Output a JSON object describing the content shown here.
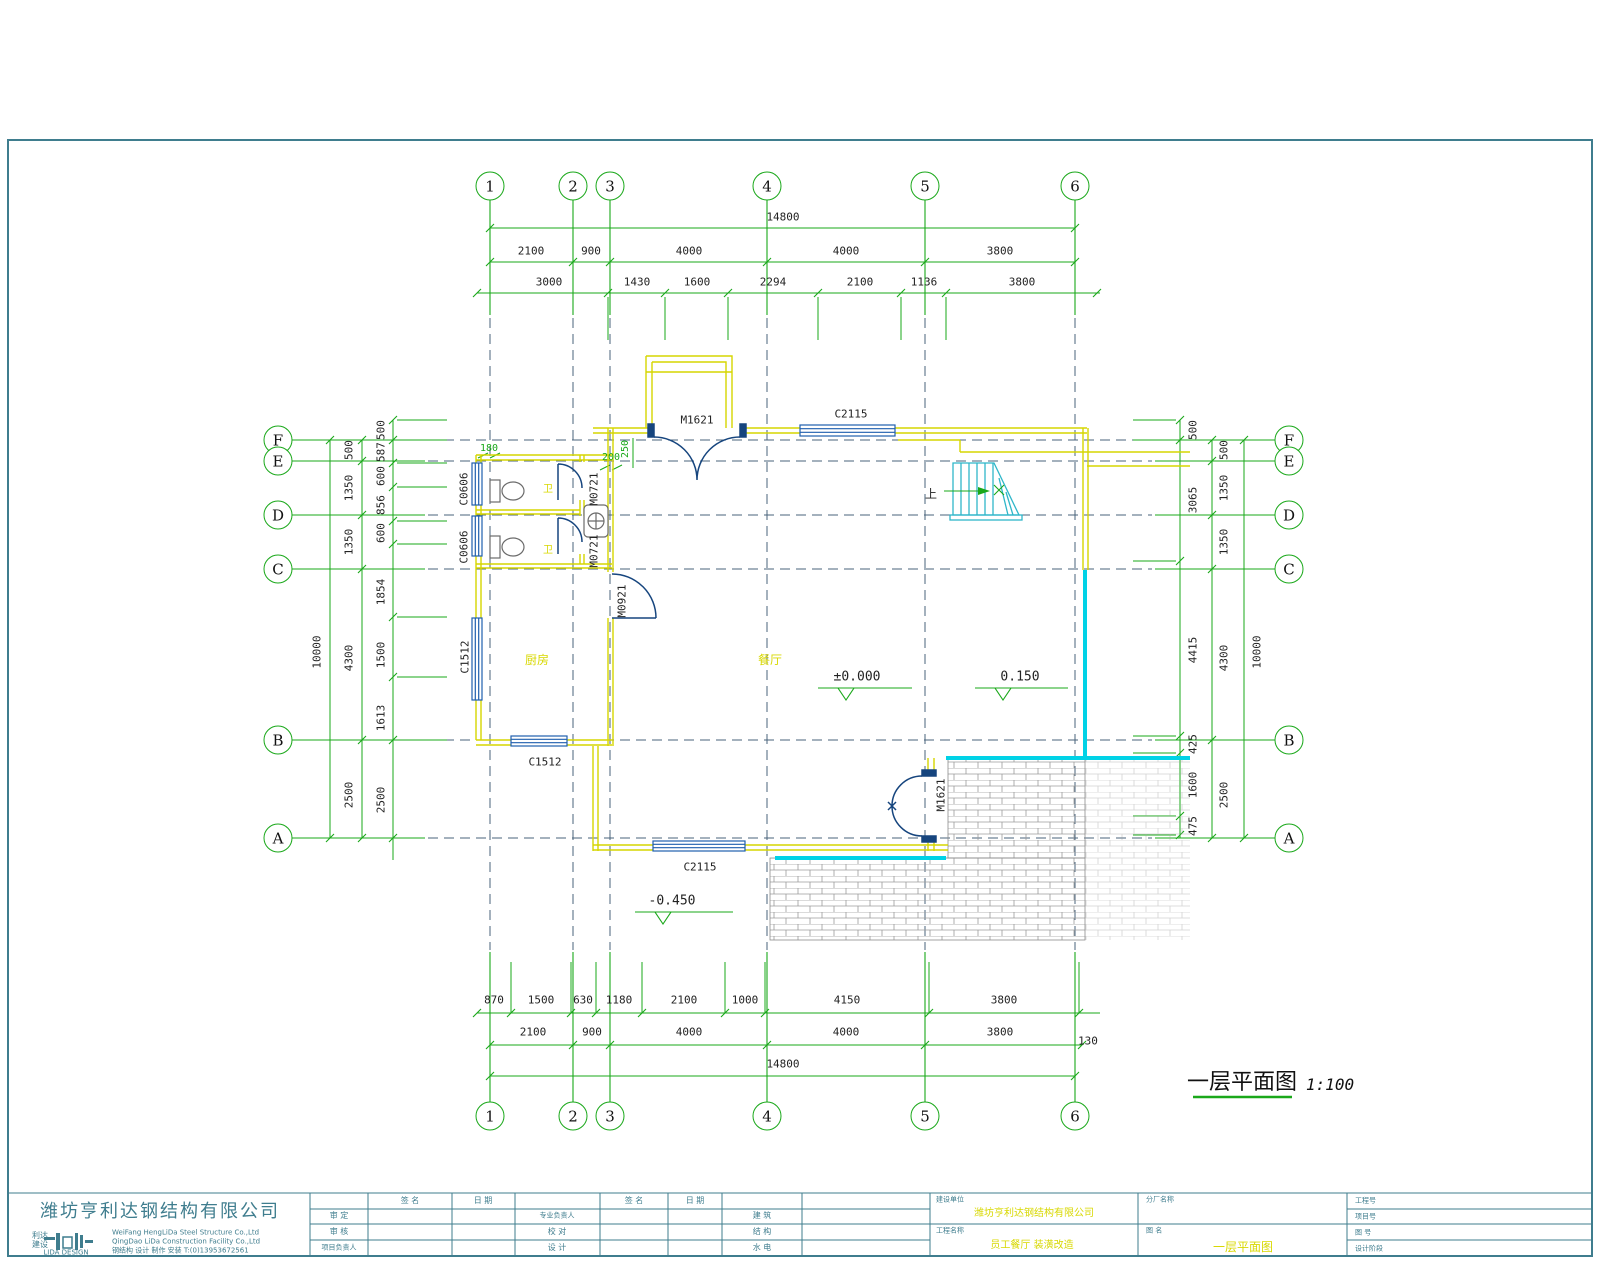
{
  "sheet": {
    "plan_title": "一层平面图",
    "plan_scale": "1:100"
  },
  "grid": {
    "cols": [
      "1",
      "2",
      "3",
      "4",
      "5",
      "6"
    ],
    "rows": [
      "F",
      "E",
      "D",
      "C",
      "B",
      "A"
    ]
  },
  "dims": {
    "top_total": "14800",
    "top_row1": [
      "2100",
      "900",
      "4000",
      "4000",
      "3800"
    ],
    "top_row2": [
      "3000",
      "1430",
      "1600",
      "2294",
      "2100",
      "1136",
      "3800"
    ],
    "bottom_row1": [
      "870",
      "1500",
      "630",
      "1180",
      "2100",
      "1000",
      "4150",
      "3800"
    ],
    "bottom_row2": [
      "2100",
      "900",
      "4000",
      "4000",
      "3800"
    ],
    "bottom_offset": "130",
    "bottom_total": "14800",
    "left_outer": "10000",
    "left_mid": [
      "500",
      "1350",
      "1350",
      "4300",
      "2500"
    ],
    "left_inner": [
      "500",
      "587",
      "600",
      "856",
      "600",
      "1854",
      "1500",
      "1613",
      "2500"
    ],
    "right_outer": "10000",
    "right_mid": [
      "500",
      "1350",
      "1350",
      "4300",
      "2500"
    ],
    "right_inner": [
      "500",
      "3065",
      "4415",
      "425",
      "1600",
      "475"
    ],
    "inline": [
      "180",
      "200",
      "250"
    ]
  },
  "openings": {
    "door_main": "M1621",
    "window_top": "C2115",
    "door_bath_1": "M0721",
    "door_bath_2": "M0721",
    "door_kitchen": "M0921",
    "window_bath_1": "C0606",
    "window_bath_2": "C0606",
    "window_kitchen_left": "C1512",
    "window_kitchen_bottom": "C1512",
    "window_bottom": "C2115",
    "door_terrace": "M1621"
  },
  "rooms": {
    "bath_1": "卫",
    "bath_2": "卫",
    "kitchen": "厨房",
    "dining": "餐厅",
    "stair_up": "上"
  },
  "levels": {
    "zero": "±0.000",
    "plus": "0.150",
    "minus": "-0.450"
  },
  "titleblock": {
    "company_cn": "潍坊亨利达钢结构有限公司",
    "logo_line1": "利达",
    "logo_line2": "建设",
    "logo_en": "LIDA DESIGN",
    "company_en1": "WeiFang HengLiDa Steel Structure Co.,Ltd",
    "company_en2": "QingDao LiDa Construction Facility Co.,Ltd",
    "company_services": "钢结构 设计 制作 安装 T:(0)13953672561",
    "sign_header": "签 名",
    "date_header": "日 期",
    "row_labels_1": [
      "审 定",
      "审 核",
      "项目负责人"
    ],
    "row_labels_2": [
      "专业负责人",
      "校 对",
      "设 计"
    ],
    "row_labels_3": [
      "建 筑",
      "结 构",
      "水 电"
    ],
    "field_owner_label": "建设单位",
    "field_owner_value": "潍坊亨利达钢结构有限公司",
    "field_project_label": "工程名称",
    "field_project_value": "员工餐厅 装潢改造",
    "field_factory_label": "分厂名称",
    "field_drawing_label": "图  名",
    "field_drawing_value": "一层平面图",
    "field_no_labels": [
      "工程号",
      "项目号",
      "图 号",
      "设计阶段"
    ]
  }
}
